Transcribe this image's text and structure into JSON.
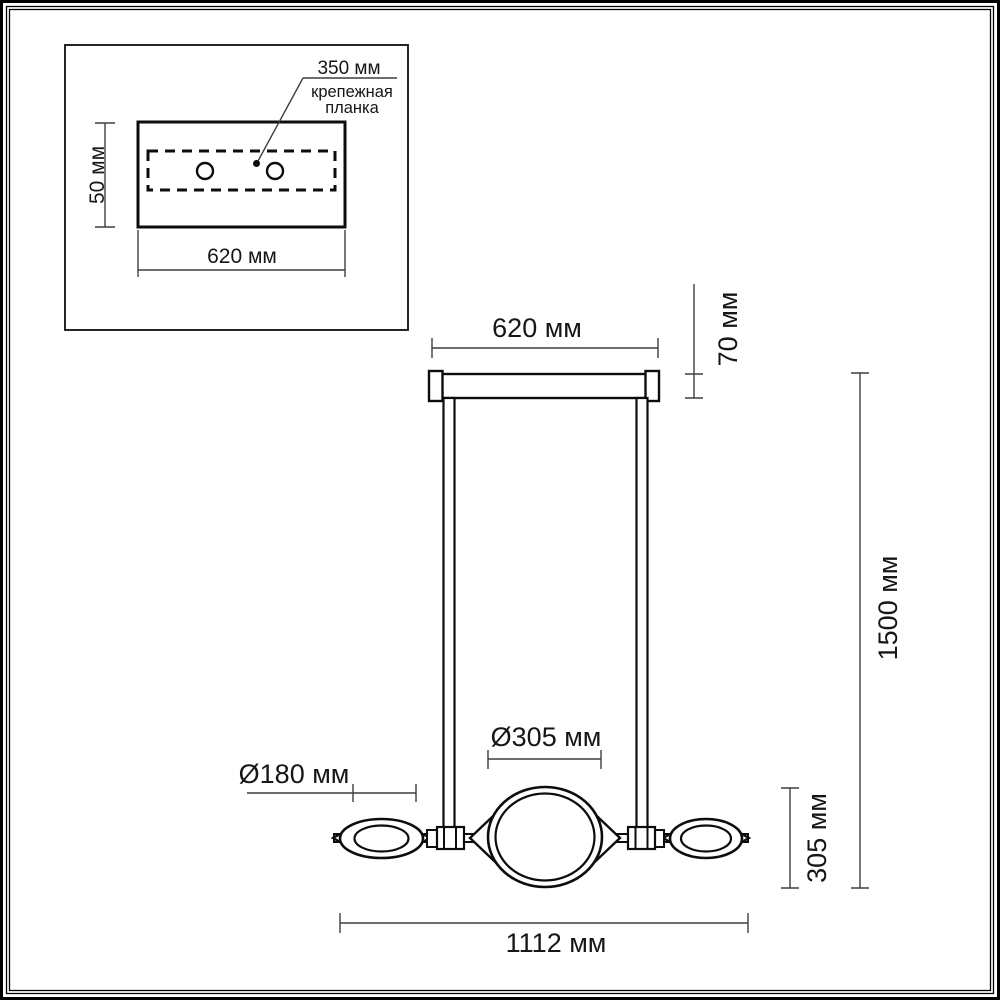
{
  "drawing": {
    "inset": {
      "plate_width_dim": "350 мм",
      "plate_label_line1": "крепежная",
      "plate_label_line2": "планка",
      "canopy_height_dim": "50 мм",
      "canopy_width_dim": "620 мм"
    },
    "front_view": {
      "canopy_width_dim": "620 мм",
      "canopy_depth_dim": "70 мм",
      "overall_height_dim": "1500 мм",
      "center_shade_diameter": "Ø305 мм",
      "side_shade_diameter": "Ø180 мм",
      "shade_height_dim": "305 мм",
      "overall_width_dim": "1112 мм"
    },
    "colors": {
      "object_line": "#0d0d0d",
      "dimension_line": "#3f3f3f",
      "background": "#ffffff"
    }
  }
}
